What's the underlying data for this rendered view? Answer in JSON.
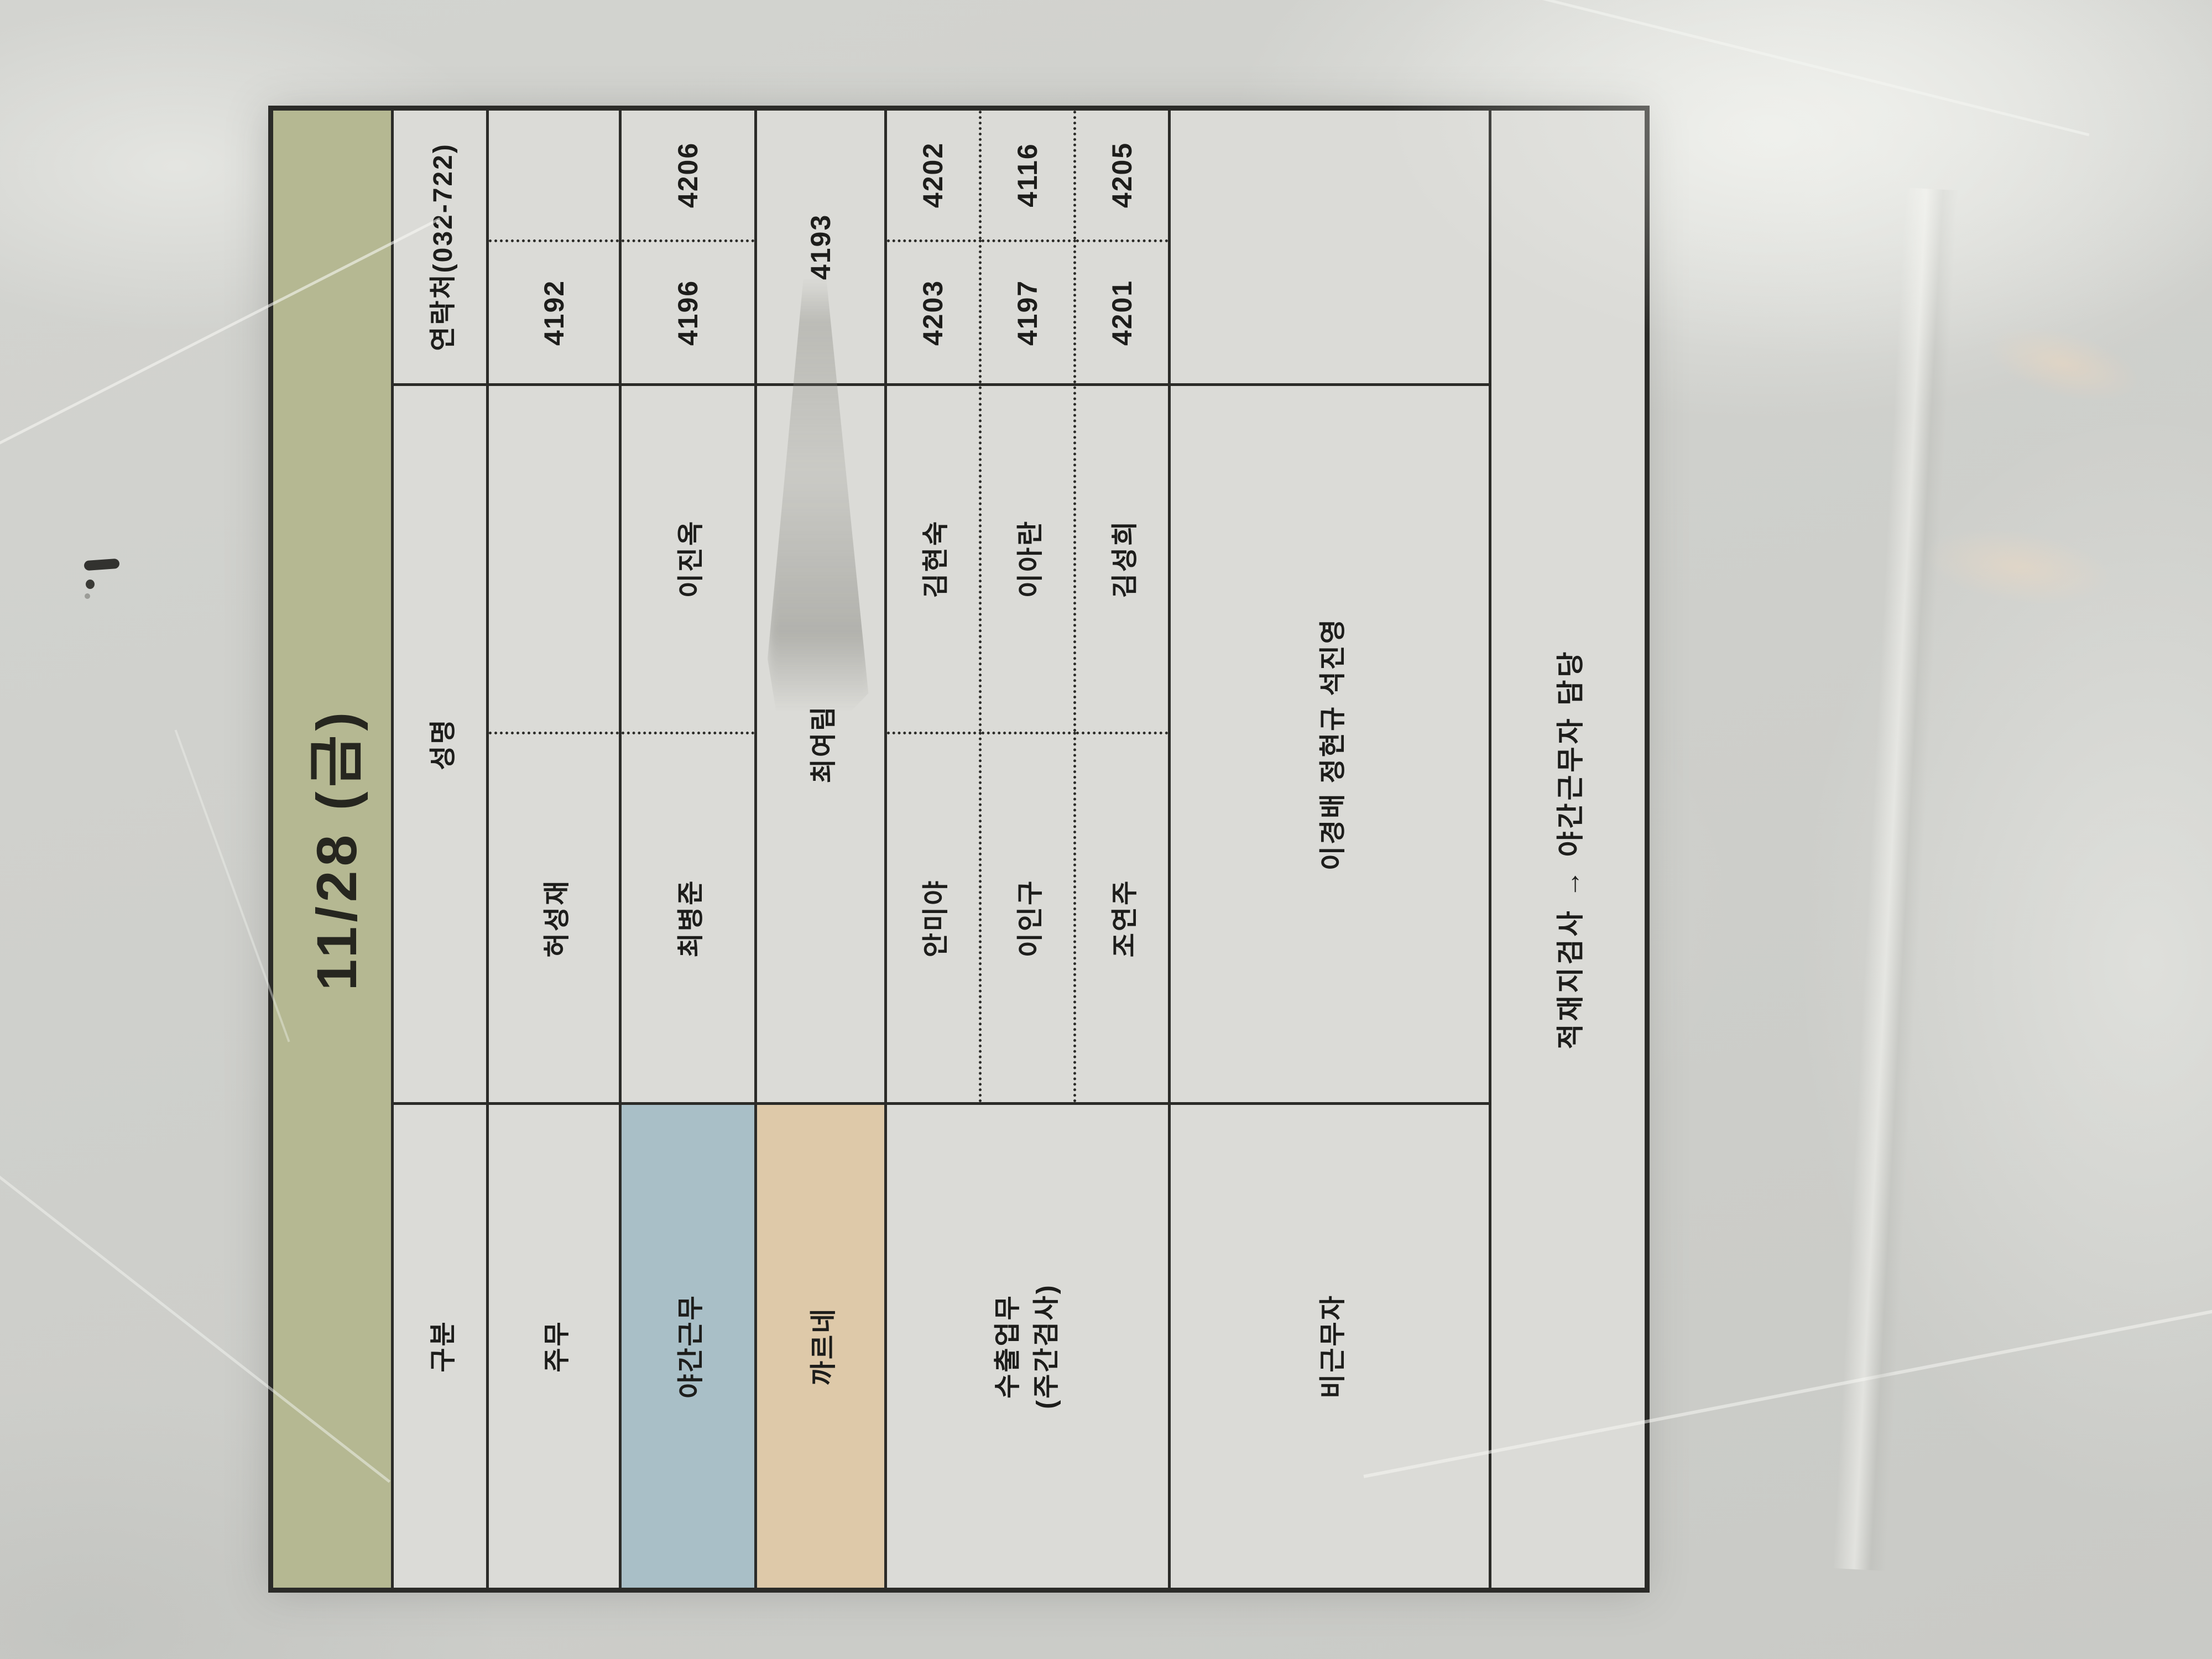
{
  "table": {
    "title": "11/28 (금)",
    "columns": {
      "category": "구분",
      "name": "성명",
      "contact": "연락처(032-722)"
    },
    "rows": {
      "jumu": {
        "category": "주무",
        "name_left": "허성재",
        "name_right": "",
        "tel_left": "4192",
        "tel_right": ""
      },
      "night": {
        "category": "야간근무",
        "name_left": "최병준",
        "name_right": "이진옥",
        "tel_left": "4196",
        "tel_right": "4206"
      },
      "carnet": {
        "category": "까르네",
        "name": "최여림",
        "tel": "4193"
      },
      "export": {
        "category_line1": "수출업무",
        "category_line2": "(주간검사)",
        "entries": [
          {
            "name_left": "안미야",
            "name_right": "김현숙",
            "tel_left": "4203",
            "tel_right": "4202"
          },
          {
            "name_left": "이인구",
            "name_right": "이아란",
            "tel_left": "4197",
            "tel_right": "4116"
          },
          {
            "name_left": "조연주",
            "name_right": "김성희",
            "tel_left": "4201",
            "tel_right": "4205"
          }
        ]
      },
      "offduty": {
        "category": "비근무자",
        "names": "이경배 정현규 석진영",
        "tel": ""
      }
    },
    "footnote": "적재지검사 → 야간근무자 담당"
  },
  "colors": {
    "title_bg": "#b5b892",
    "night_shift_bg": "#a9bfc7",
    "carnet_bg": "#dec9a9",
    "paper": "#dbdbd7",
    "grid_line": "#2b2b28",
    "ink": "#1d1d1b"
  }
}
